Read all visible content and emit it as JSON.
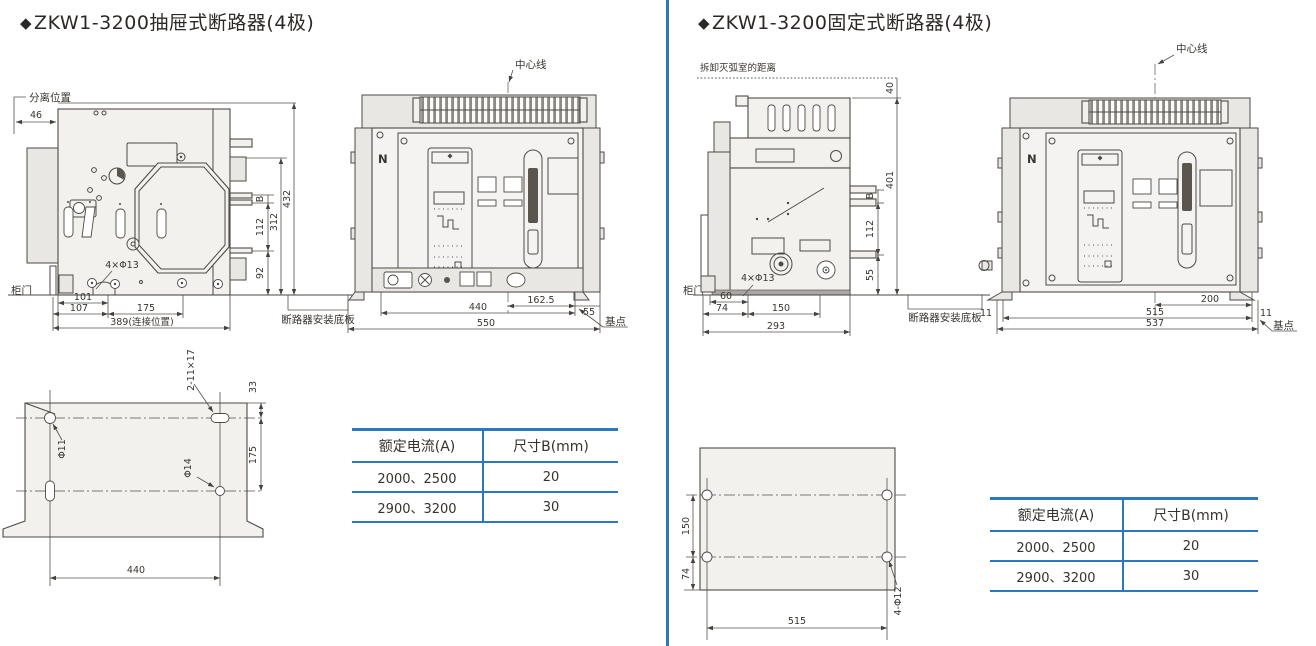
{
  "colors": {
    "accent_blue": "#2b78bf",
    "ink": "#39352f",
    "drawing_fill": "#f2f1ee"
  },
  "left_panel": {
    "title_bullet": "◆",
    "title": "ZKW1-3200抽屉式断路器(4极)",
    "side_view": {
      "separation_position": "分离位置",
      "d46": "46",
      "door": "柜门",
      "holes": "4×Φ13",
      "d101": "101",
      "d107": "107",
      "d175": "175",
      "d389": "389(连接位置)",
      "dB": "B",
      "d112": "112",
      "d92": "92",
      "d312": "312",
      "d432": "432",
      "base_plate": "断路器安装底板"
    },
    "front_view": {
      "center_line": "中心线",
      "pole_n": "N",
      "d440": "440",
      "d162_5": "162.5",
      "d55": "55",
      "d550": "550",
      "base_point": "基点"
    },
    "mounting_plate": {
      "slot_label": "2-11×17",
      "d33": "33",
      "d175": "175",
      "dia11": "Φ11",
      "dia14": "Φ14",
      "d440": "440"
    },
    "table": {
      "headers": [
        "额定电流(A)",
        "尺寸B(mm)"
      ],
      "rows": [
        [
          "2000、2500",
          "20"
        ],
        [
          "2900、3200",
          "30"
        ]
      ]
    }
  },
  "right_panel": {
    "title_bullet": "◆",
    "title": "ZKW1-3200固定式断路器(4极)",
    "side_view": {
      "arc_note": "拆卸灭弧室的距离",
      "d40": "40",
      "d401": "401",
      "dB": "B",
      "d112": "112",
      "d55": "55",
      "door": "柜门",
      "holes": "4×Φ13",
      "d60": "60",
      "d74": "74",
      "d150": "150",
      "d293": "293",
      "base_plate": "断路器安装底板"
    },
    "front_view": {
      "center_line": "中心线",
      "pole_n": "N",
      "d200": "200",
      "d515": "515",
      "d537": "537",
      "d11_left": "11",
      "d11_right": "11",
      "base_point": "基点"
    },
    "mounting_plate": {
      "d150": "150",
      "d74": "74",
      "d515": "515",
      "holes": "4-Φ12"
    },
    "table": {
      "headers": [
        "额定电流(A)",
        "尺寸B(mm)"
      ],
      "rows": [
        [
          "2000、2500",
          "20"
        ],
        [
          "2900、3200",
          "30"
        ]
      ]
    }
  }
}
